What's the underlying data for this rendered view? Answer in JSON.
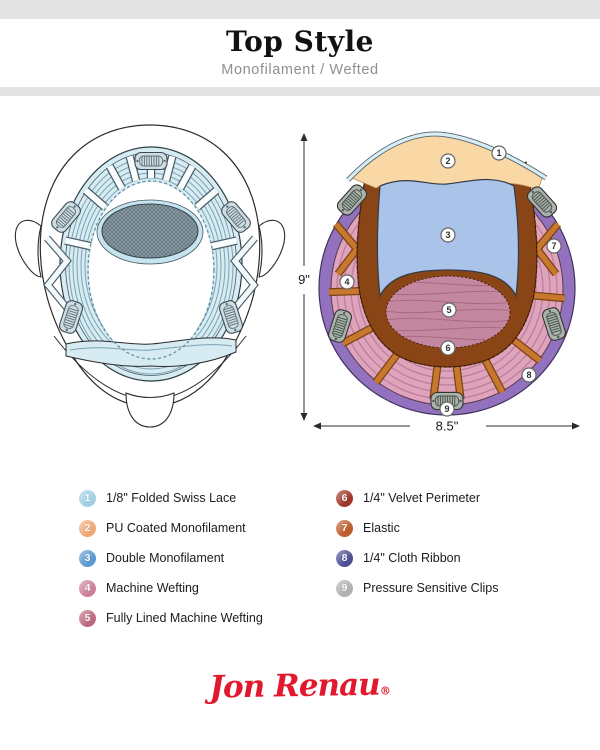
{
  "header": {
    "title": "Top Style",
    "subtitle": "Monofilament / Wefted"
  },
  "legend": {
    "left": [
      {
        "num": "1",
        "label": "1/8\" Folded Swiss Lace",
        "dot_color": "#9fd0e4",
        "fill_color": "#d9eef4"
      },
      {
        "num": "2",
        "label": "PU Coated Monofilament",
        "dot_color": "#f0a878",
        "fill_color": "#f9d8a6"
      },
      {
        "num": "3",
        "label": "Double Monofilament",
        "dot_color": "#5b9ad0",
        "fill_color": "#a9c4e8"
      },
      {
        "num": "4",
        "label": "Machine Wefting",
        "dot_color": "#cc7f9b",
        "fill_color": "#dfa3bb"
      },
      {
        "num": "5",
        "label": "Fully Lined Machine Wefting",
        "dot_color": "#bd6a80",
        "fill_color": "#c487a0"
      }
    ],
    "right": [
      {
        "num": "6",
        "label": "1/4\" Velvet Perimeter",
        "dot_color": "#9e372a",
        "fill_color": "#8a4517"
      },
      {
        "num": "7",
        "label": "Elastic",
        "dot_color": "#bd5c2d",
        "fill_color": "#c7772e"
      },
      {
        "num": "8",
        "label": "1/4\" Cloth Ribbon",
        "dot_color": "#4f4f96",
        "fill_color": "#9272bf"
      },
      {
        "num": "9",
        "label": "Pressure Sensitive Clips",
        "dot_color": "#b1b1b1",
        "fill_color": "#a9b3ab"
      }
    ]
  },
  "diagram": {
    "height_label": "9\"",
    "width_label": "8.5\""
  },
  "logo": {
    "brand": "Jon Renau",
    "registered": "®",
    "color": "#e0192c"
  }
}
